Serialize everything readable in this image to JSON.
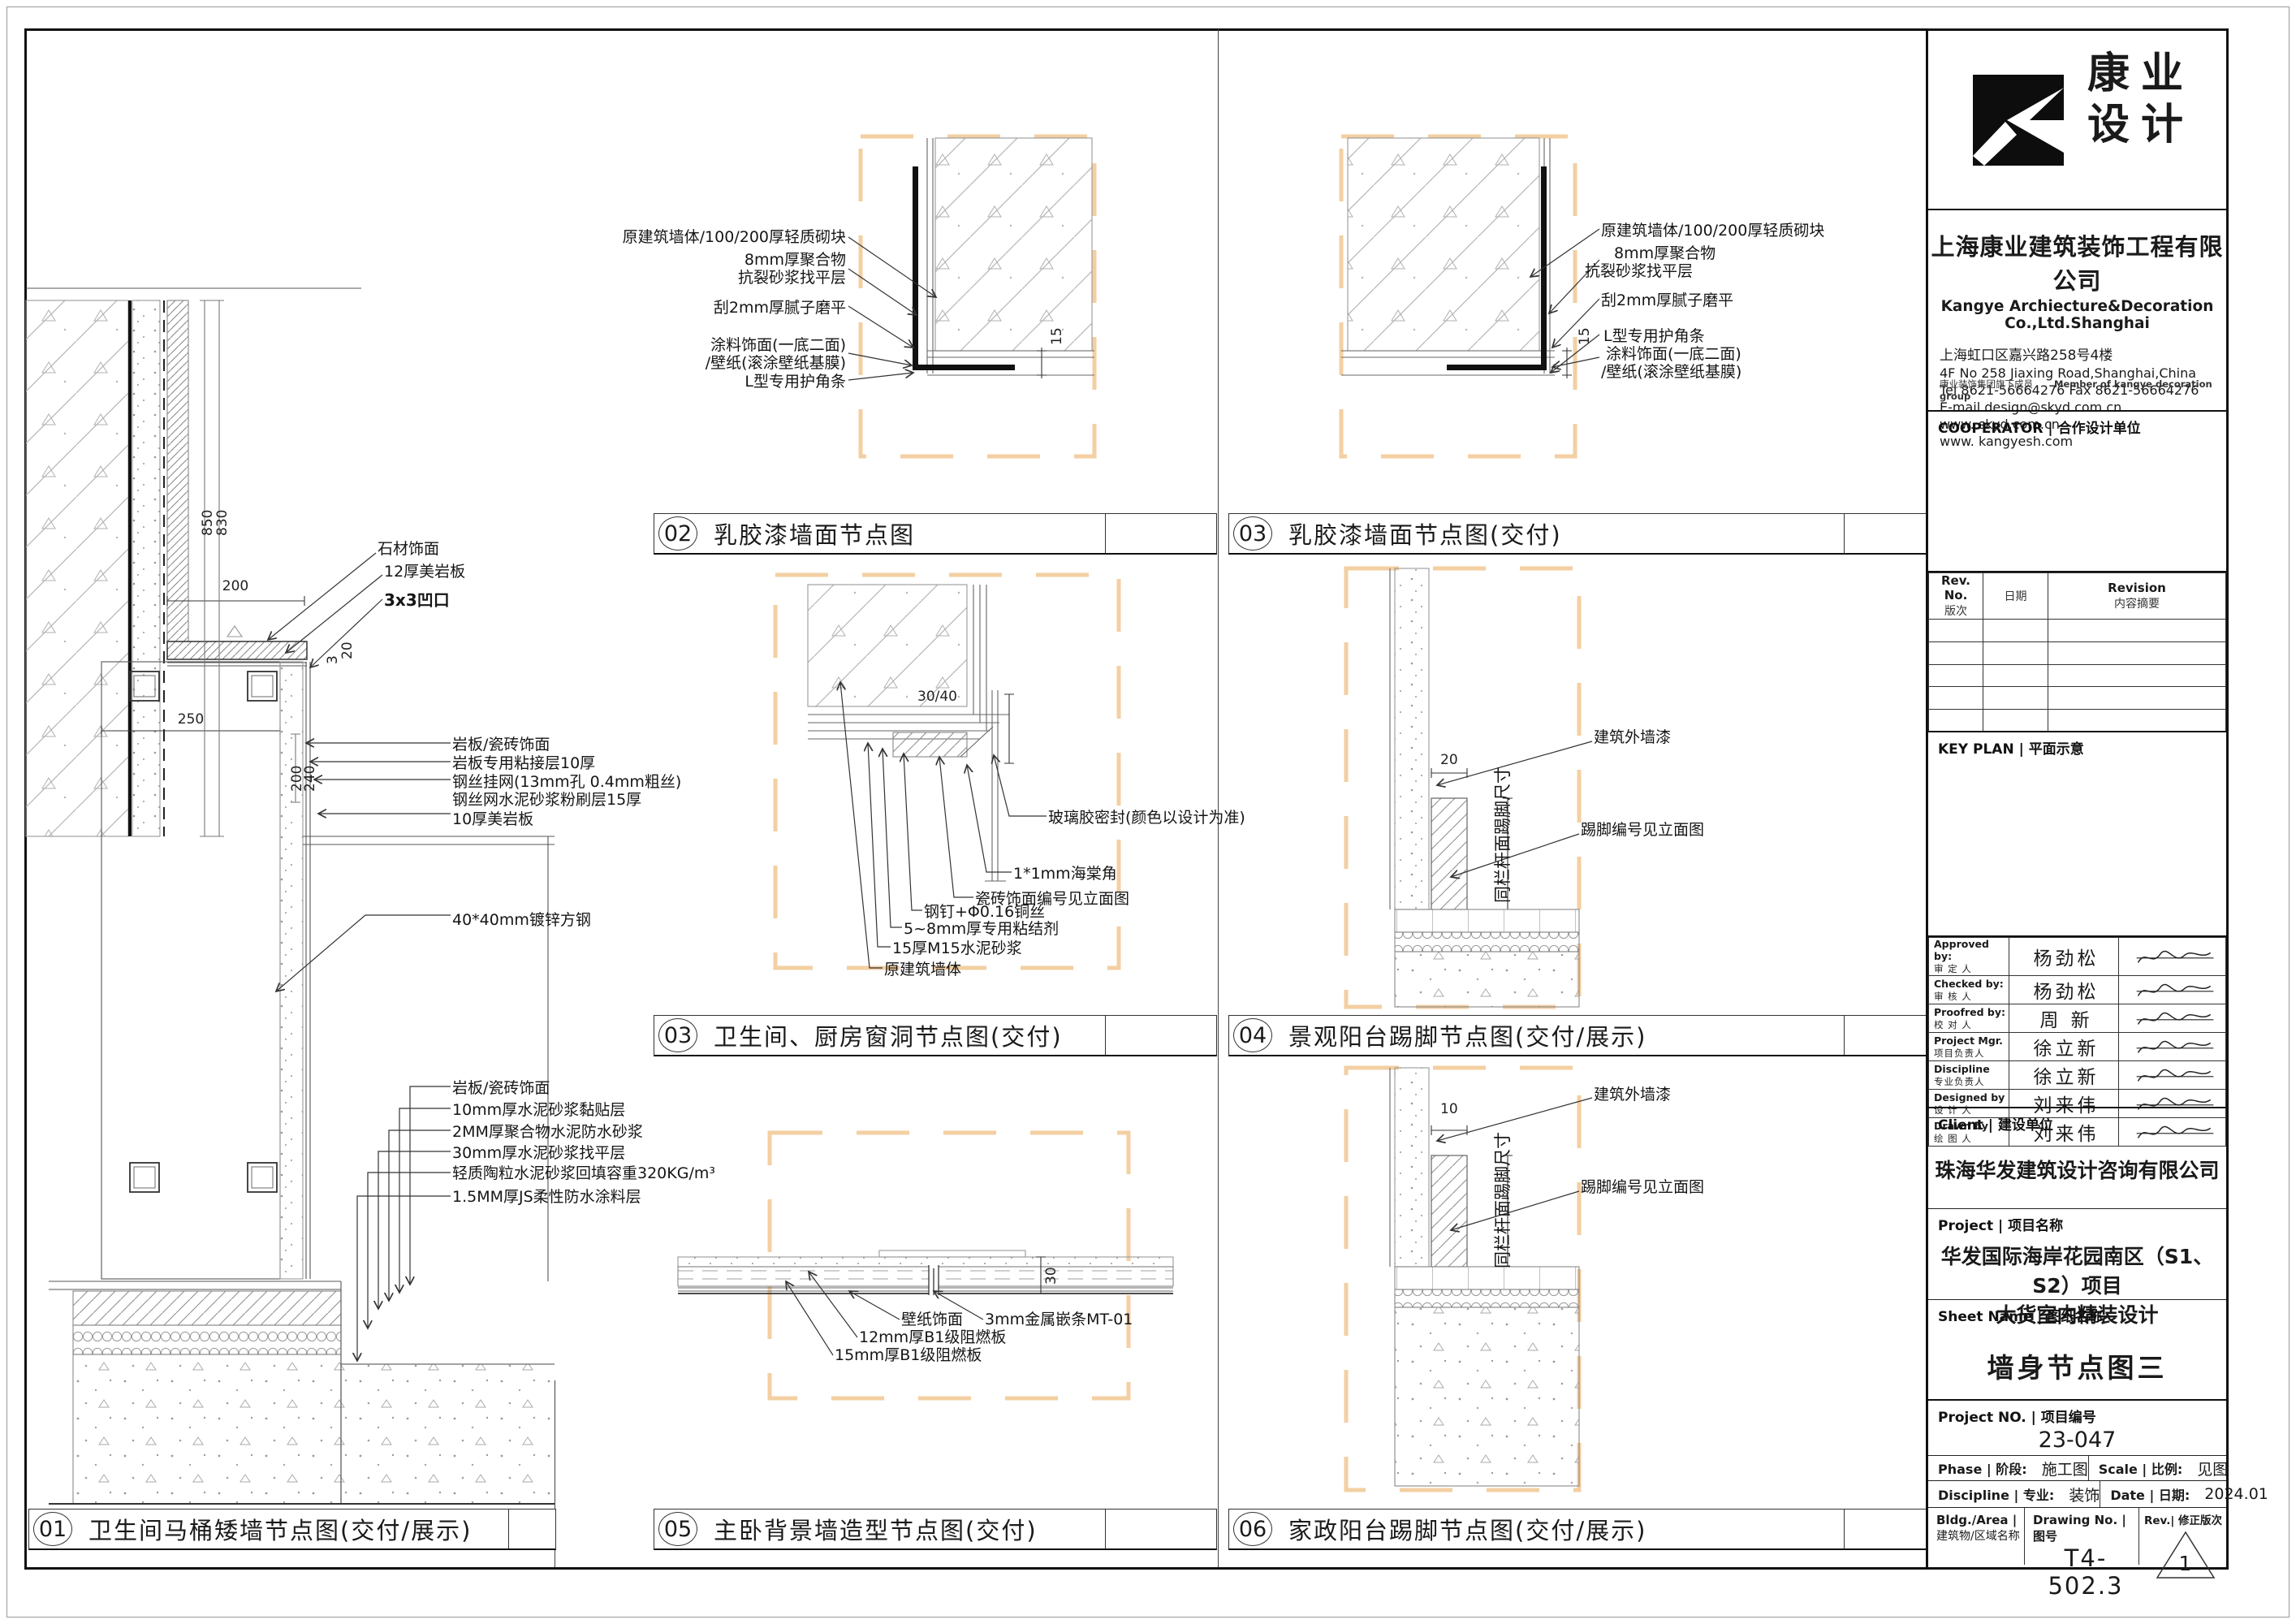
{
  "panels": {
    "d01": {
      "num": "01",
      "title": "卫生间马桶矮墙节点图(交付/展示)",
      "labels_top": [
        "石材饰面",
        "12厚美岩板",
        "3x3凹口"
      ],
      "labels_mid": [
        "岩板/瓷砖饰面",
        "岩板专用粘接层10厚",
        "钢丝挂网(13mm孔 0.4mm粗丝)",
        "钢丝网水泥砂浆粉刷层15厚",
        "10厚美岩板",
        "40*40mm镀锌方钢"
      ],
      "labels_low": [
        "岩板/瓷砖饰面",
        "10mm厚水泥砂浆黏贴层",
        "2MM厚聚合物水泥防水砂浆",
        "30mm厚水泥砂浆找平层",
        "轻质陶粒水泥砂浆回填容重320KG/m³",
        "1.5MM厚JS柔性防水涂料层"
      ],
      "dims": {
        "w200": "200",
        "w250": "250",
        "h850": "850",
        "h830": "830",
        "t20": "20",
        "t3": "3",
        "v200": "200",
        "v240": "240"
      }
    },
    "d02": {
      "num": "02",
      "title": "乳胶漆墙面节点图",
      "labels": [
        "原建筑墙体/100/200厚轻质砌块",
        "8mm厚聚合物",
        "抗裂砂浆找平层",
        "刮2mm厚腻子磨平",
        "涂料饰面(一底二面)",
        "/壁纸(滚涂壁纸基膜)",
        "L型专用护角条"
      ],
      "dim": "15"
    },
    "d03t": {
      "num": "03",
      "title": "乳胶漆墙面节点图(交付)",
      "labels": [
        "原建筑墙体/100/200厚轻质砌块",
        "8mm厚聚合物",
        "抗裂砂浆找平层",
        "刮2mm厚腻子磨平",
        "L型专用护角条",
        "涂料饰面(一底二面)",
        "/壁纸(滚涂壁纸基膜)"
      ],
      "dim": "15"
    },
    "d03m": {
      "num": "03",
      "title": "卫生间、厨房窗洞节点图(交付)",
      "labels": [
        "玻璃胶密封(颜色以设计为准)",
        "1*1mm海棠角",
        "瓷砖饰面编号见立面图",
        "钢钉+Φ0.16铜丝",
        "5~8mm厚专用粘结剂",
        "15厚M15水泥砂浆",
        "原建筑墙体"
      ],
      "dim": "30/40"
    },
    "d04": {
      "num": "04",
      "title": "景观阳台踢脚节点图(交付/展示)",
      "labels": [
        "建筑外墙漆",
        "踢脚编号见立面图"
      ],
      "vlabel": "同栏杆面踢脚尺寸",
      "dim": "20"
    },
    "d05": {
      "num": "05",
      "title": "主卧背景墙造型节点图(交付)",
      "labels": [
        "壁纸饰面",
        "3mm金属嵌条MT-01",
        "12mm厚B1级阻燃板",
        "15mm厚B1级阻燃板"
      ],
      "dim": "30"
    },
    "d06": {
      "num": "06",
      "title": "家政阳台踢脚节点图(交付/展示)",
      "labels": [
        "建筑外墙漆",
        "踢脚编号见立面图"
      ],
      "vlabel": "同栏杆面踢脚尺寸",
      "dim": "10"
    }
  },
  "titleblock": {
    "logo_cn": "康业\n设计",
    "company_cn": "上海康业建筑装饰工程有限公司",
    "company_en": "Kangye Archiecture&Decoration Co.,Ltd.Shanghai",
    "addr_cn": "上海虹口区嘉兴路258号4楼",
    "addr_en": "4F No 258 Jiaxing Road,Shanghai,China",
    "tel": "Tel 8621-56664276  Fax 8621-56664276",
    "email": "E-mail design@skyd.com.cn",
    "web1": "www. skyd.com.cn",
    "web2": "www. kangyesh.com",
    "member_cn": "康业装饰集团旗下成员",
    "member_en": "Member of kangye decoration group",
    "cooperator": "COOPERATOR | 合作设计单位",
    "rev_c1en": "Rev. No.",
    "rev_c1cn": "版次",
    "rev_c2": "日期",
    "rev_c3en": "Revision",
    "rev_c3cn": "内容摘要",
    "keyplan": "KEY PLAN | 平面示意",
    "approvals": [
      {
        "en": "Approved by:",
        "cn": "审 定 人",
        "name": "杨劲松"
      },
      {
        "en": "Checked by:",
        "cn": "审 核 人",
        "name": "杨劲松"
      },
      {
        "en": "Proofred by:",
        "cn": "校 对 人",
        "name": "周 新"
      },
      {
        "en": "Project Mgr.",
        "cn": "项目负责人",
        "name": "徐立新"
      },
      {
        "en": "Discipline",
        "cn": "专业负责人",
        "name": "徐立新"
      },
      {
        "en": "Designed by",
        "cn": "设 计 人",
        "name": "刘来伟"
      },
      {
        "en": "Drawn by",
        "cn": "绘 图 人",
        "name": "刘来伟"
      }
    ],
    "client_label": "Client | 建设单位",
    "client_name": "珠海华发建筑设计咨询有限公司",
    "project_label": "Project | 项目名称",
    "project_line1": "华发国际海岸花园南区（S1、S2）项目",
    "project_line2": "大货室内精装设计",
    "sheet_label": "Sheet Name | 图纸名称",
    "sheet_value": "墙身节点图三",
    "projno_label": "Project NO. | 项目编号",
    "projno_value": "23-047",
    "phase_label": "Phase | 阶段:",
    "phase_value": "施工图",
    "scale_label": "Scale | 比例:",
    "scale_value": "见图",
    "disc_label": "Discipline | 专业:",
    "disc_value": "装饰",
    "date_label": "Date | 日期:",
    "date_value": "2024.01",
    "bldg_label1": "Bldg./Area |",
    "bldg_label2": "建筑物/区域名称",
    "dwg_label": "Drawing No. | 图号",
    "dwg_value": "T4-502.3",
    "rev_label": "Rev.| 修正版次",
    "rev_value": "1"
  },
  "colors": {
    "accent_dash": "#f3cfa2",
    "line": "#333333"
  }
}
